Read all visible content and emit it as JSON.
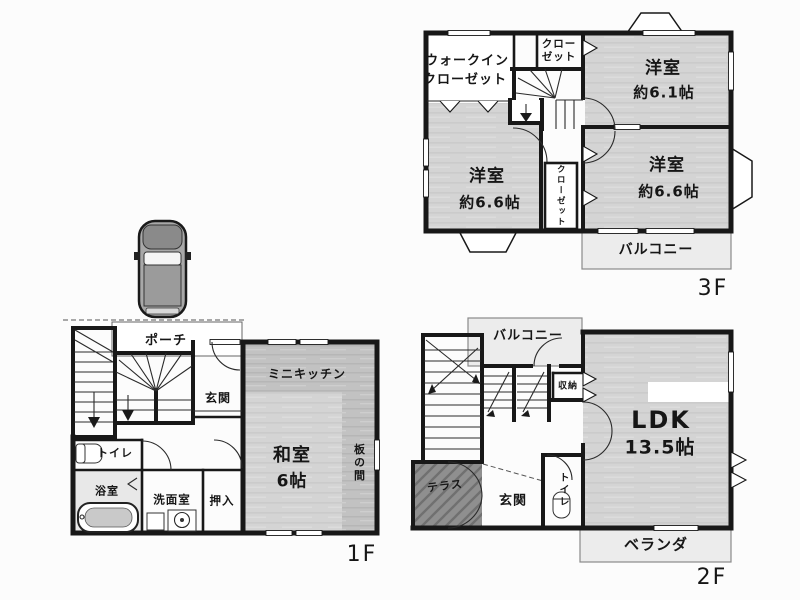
{
  "palette": {
    "wall": "#181818",
    "room_gray": "#d4d4d4",
    "kitchen_gray": "#c2c2c2",
    "terrace_gray": "#8f8f8f",
    "balcony_gray": "#ececec",
    "background": "#fcfcfc"
  },
  "floors": {
    "f3": {
      "floor_label": "3F",
      "walkin_closet_line1": "ウォークイン",
      "walkin_closet_line2": "クローゼット",
      "closet_top_line1": "クロー",
      "closet_top_line2": "ゼット",
      "bedroom_a_name": "洋室",
      "bedroom_a_size": "約6.1帖",
      "bedroom_b_name": "洋室",
      "bedroom_b_size": "約6.6帖",
      "bedroom_c_name": "洋室",
      "bedroom_c_size": "約6.6帖",
      "closet_mid": "クローゼット",
      "balcony": "バルコニー"
    },
    "f2": {
      "floor_label": "2F",
      "balcony": "バルコニー",
      "storage": "収納",
      "ldk_name": "LDK",
      "ldk_size": "13.5帖",
      "terrace": "テラス",
      "entrance": "玄関",
      "toilet": "トイレ",
      "veranda": "ベランダ"
    },
    "f1": {
      "floor_label": "1F",
      "porch": "ポーチ",
      "mini_kitchen": "ミニキッチン",
      "entrance": "玄関",
      "washitsu_name": "和室",
      "washitsu_size": "6帖",
      "itanoma": "板の間",
      "toilet": "トイレ",
      "bathroom": "浴室",
      "washroom": "洗面室",
      "oshiire": "押入"
    }
  }
}
